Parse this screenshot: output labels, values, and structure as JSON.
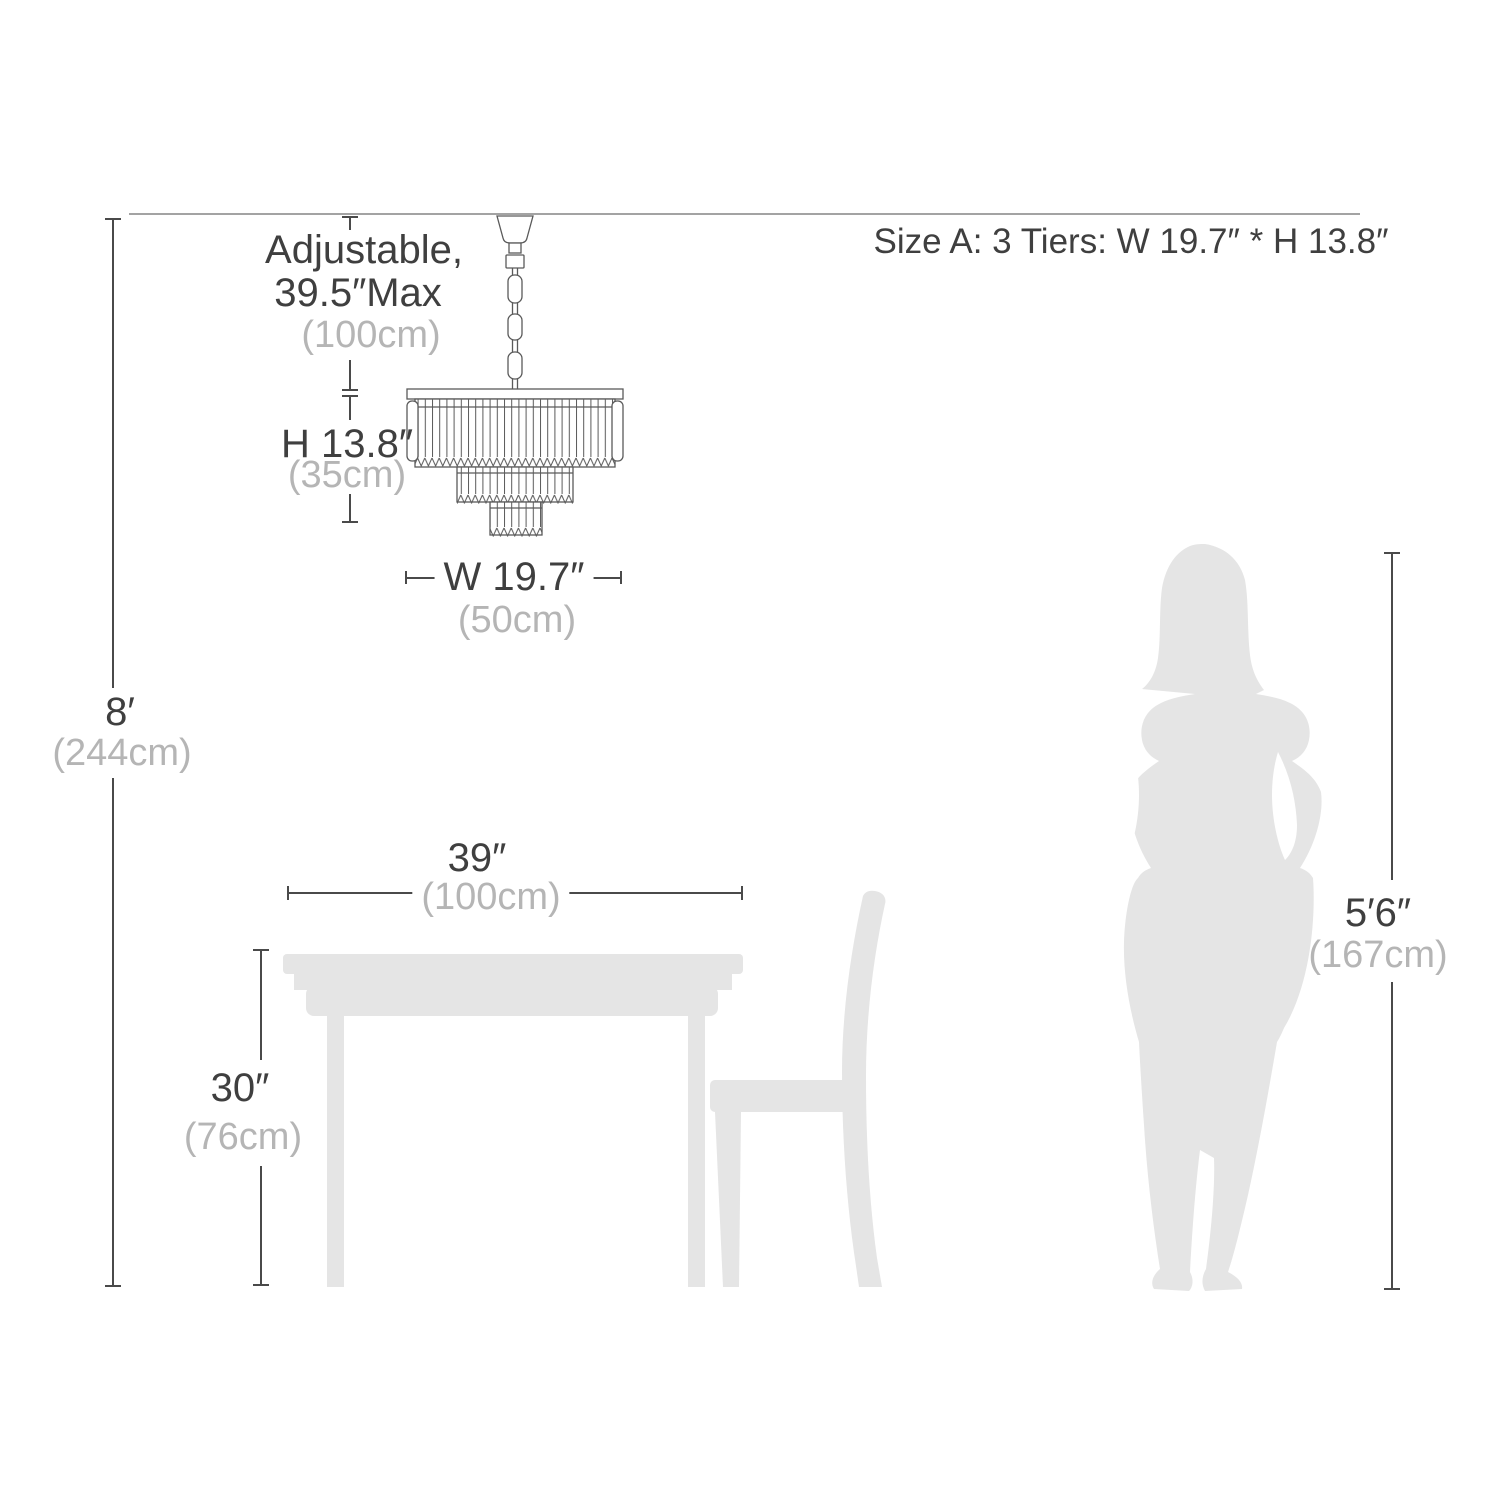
{
  "colors": {
    "dark_text": "#3f3f3f",
    "muted_text": "#b5b5b5",
    "silhouette": "#e5e5e5",
    "dimension_line": "#4a4a4a",
    "ceiling_line": "#a3a3a3"
  },
  "header": {
    "size_note": "Size A: 3 Tiers: W 19.7″ * H 13.8″"
  },
  "chandelier": {
    "adjustable_line1": "Adjustable,",
    "adjustable_line2": "39.5″Max",
    "adjustable_metric": "(100cm)",
    "height_label": "H 13.8″",
    "height_metric": "(35cm)",
    "width_label": "W 19.7″",
    "width_metric": "(50cm)"
  },
  "room": {
    "ceiling_height_label": "8′",
    "ceiling_height_metric": "(244cm)"
  },
  "table": {
    "width_label": "39″",
    "width_metric": "(100cm)",
    "height_label": "30″",
    "height_metric": "(76cm)"
  },
  "person": {
    "height_label": "5′6″",
    "height_metric": "(167cm)"
  }
}
